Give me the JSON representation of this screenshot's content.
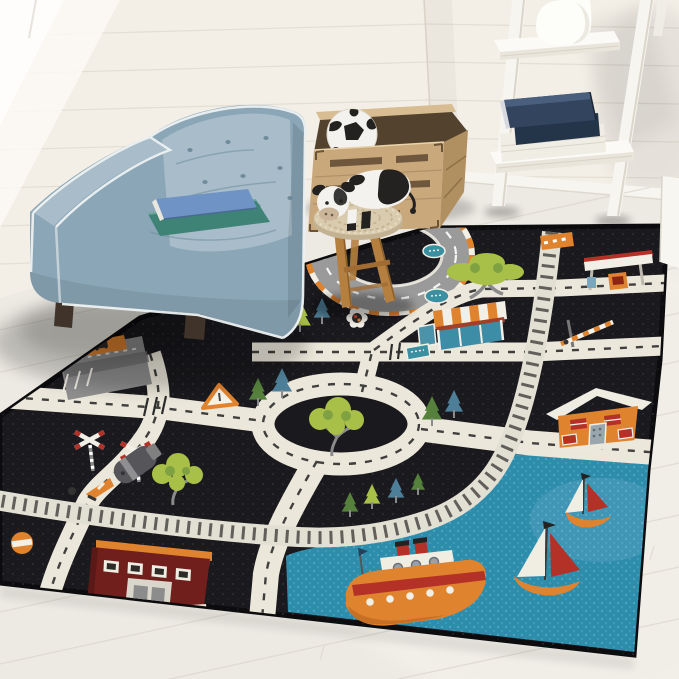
{
  "scene": {
    "description": "Bright playroom corner with a light-blue tufted cube armchair holding two books, a wooden toy crate with a plush soccer ball, a crochet-topped wooden stool with a black-and-white plush cow, a white ladder shelf with a vase and navy books, all arranged around a black kids road-map play rug with roads, a railway, a harbor pond with boats, houses and traffic signs.",
    "setting": "white shiplap walls, pale wood plank floor"
  },
  "palette": {
    "wall": "#f3efe7",
    "wall_lit": "#fbf9f4",
    "plank_line": "#e2ddd1",
    "floor": "#edeae3",
    "floor_line": "#dcd7cd",
    "baseboard": "#f7f5ef",
    "rug_black": "#1a191d",
    "rug_dot": "#3a393f",
    "rug_edge": "#0c0c0e",
    "road": "#ebe7da",
    "road_dash": "#2d2d2d",
    "track_base": "#e2dfd3",
    "track_tie": "#605f5a",
    "pond": "#2f8dac",
    "pond_dot": "#79c6dc",
    "orange": "#e0832f",
    "red": "#b43127",
    "maroon": "#701f1d",
    "lime": "#a9c048",
    "green": "#55813c",
    "tree_blue": "#4e7f98",
    "teal": "#3a8fa0",
    "gray": "#9b9b9b",
    "gray_dark": "#55555a",
    "white": "#f2efe6",
    "chair": "#8ba6b7",
    "chair_light": "#a8bdc9",
    "piping": "#eef2f2",
    "foot_brown": "#3f332a",
    "crate_wood": "#c9a87c",
    "crate_side": "#b08f60",
    "crate_rim": "#d9bd92",
    "crate_slot": "#6e573c",
    "stool_wood": "#b5803f",
    "crochet": "#d9cbad",
    "crochet_line": "#c2ae8a",
    "cow_white": "#f4f2ee",
    "cow_black": "#242220",
    "muzzle": "#cbb59a",
    "navy": "#32445e",
    "navy_dark": "#24354a",
    "book_blue": "#6f93c4",
    "book_green": "#3f8376",
    "vase": "#fdfdfa"
  },
  "objects": {
    "wall": {
      "label": "white shiplap wall with window light"
    },
    "floor": {
      "label": "pale wood plank floor"
    },
    "rug": {
      "label": "black kids city road play rug",
      "features": [
        "road grid with dashed lane markings",
        "central roundabout with tree",
        "oval race track with striped curb",
        "railway track with crossing gate",
        "harbor pond with steamboat and two sailboats",
        "gas station",
        "striped-awning shop",
        "orange house",
        "dark red schoolhouse",
        "parking lot with car sign",
        "pine and leafy trees",
        "yield sign",
        "flower medallion",
        "railroad crossing signs",
        "do-not-enter sign",
        "traffic cone",
        "teal street signs"
      ]
    },
    "armchair": {
      "label": "light blue tufted cube armchair with white piping",
      "books": [
        "blue hardcover book",
        "green hardcover book"
      ]
    },
    "crate": {
      "label": "natural wood slatted toy crate",
      "contents": "plush soccer ball"
    },
    "stool": {
      "label": "wooden stool with crochet top",
      "toy": "black-and-white plush cow"
    },
    "ladder_shelf": {
      "label": "white leaning ladder shelf",
      "top_item": "white ceramic vase",
      "shelf_items": [
        "navy blue books",
        "white books"
      ]
    },
    "side_panel": {
      "label": "white furniture edge at right"
    }
  }
}
